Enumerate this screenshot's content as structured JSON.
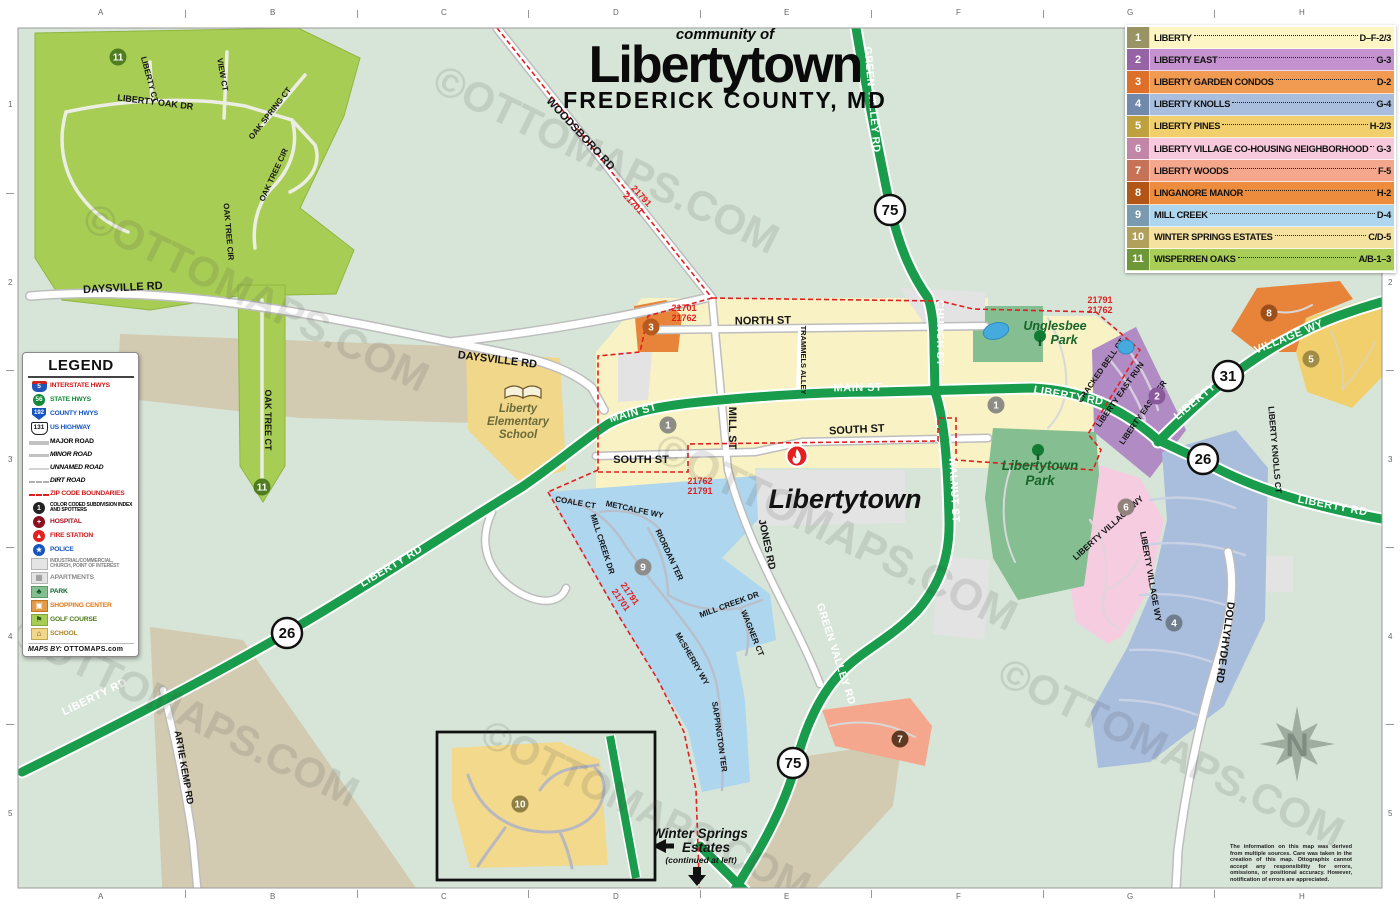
{
  "title": {
    "community": "community of",
    "name": "Libertytown",
    "county": "FREDERICK COUNTY, MD"
  },
  "watermark": "©OTTOMAPS.COM",
  "grid": {
    "cols": [
      "A",
      "B",
      "C",
      "D",
      "E",
      "F",
      "G",
      "H"
    ],
    "rows": [
      "1",
      "2",
      "3",
      "4",
      "5"
    ]
  },
  "index": {
    "rows": [
      {
        "num": "1",
        "name": "LIBERTY",
        "ref": "D–F-2/3",
        "row_color": "#fdf5c4",
        "num_color": "#9a9464"
      },
      {
        "num": "2",
        "name": "LIBERTY EAST",
        "ref": "G-3",
        "row_color": "#c493cf",
        "num_color": "#9663a5"
      },
      {
        "num": "3",
        "name": "LIBERTY GARDEN CONDOS",
        "ref": "D-2",
        "row_color": "#f09a52",
        "num_color": "#dd6f28"
      },
      {
        "num": "4",
        "name": "LIBERTY KNOLLS",
        "ref": "G-4",
        "row_color": "#a9bddd",
        "num_color": "#7189ab"
      },
      {
        "num": "5",
        "name": "LIBERTY PINES",
        "ref": "H-2/3",
        "row_color": "#f1cf6d",
        "num_color": "#bfa03e"
      },
      {
        "num": "6",
        "name": "LIBERTY VILLAGE CO-HOUSING NEIGHBORHOOD",
        "ref": "G-3",
        "row_color": "#f6c9dc",
        "num_color": "#c287a6"
      },
      {
        "num": "7",
        "name": "LIBERTY WOODS",
        "ref": "F-5",
        "row_color": "#f4a78d",
        "num_color": "#c67257"
      },
      {
        "num": "8",
        "name": "LINGANORE MANOR",
        "ref": "H-2",
        "row_color": "#ec8c3c",
        "num_color": "#b25618"
      },
      {
        "num": "9",
        "name": "MILL CREEK",
        "ref": "D-4",
        "row_color": "#aed6ee",
        "num_color": "#7a9ab0"
      },
      {
        "num": "10",
        "name": "WINTER SPRINGS ESTATES",
        "ref": "C/D-5",
        "row_color": "#f5e2a0",
        "num_color": "#b0a05c"
      },
      {
        "num": "11",
        "name": "WISPERREN OAKS",
        "ref": "A/B-1–3",
        "row_color": "#a9ce57",
        "num_color": "#6e9737"
      }
    ]
  },
  "legend": {
    "title": "LEGEND",
    "items": [
      {
        "label": "INTERSTATE HWYS",
        "num": "5",
        "color": "#d01818"
      },
      {
        "label": "STATE HWYS",
        "num": "56",
        "color": "#118a38"
      },
      {
        "label": "COUNTY HWYS",
        "num": "192",
        "color": "#1555c0"
      },
      {
        "label": "US HIGHWAY",
        "num": "131",
        "color": "#1555c0"
      },
      {
        "label": "MAJOR ROAD",
        "color": "#111111"
      },
      {
        "label": "MINOR ROAD",
        "color": "#111111"
      },
      {
        "label": "UNNAMED ROAD",
        "color": "#111111"
      },
      {
        "label": "DIRT ROAD",
        "color": "#111111"
      },
      {
        "label": "ZIP CODE BOUNDARIES",
        "color": "#d01818"
      },
      {
        "label": "COLOR CODED SUBDIVISION INDEX AND SPOTTERS",
        "color": "#111111"
      },
      {
        "label": "HOSPITAL",
        "color": "#b01020"
      },
      {
        "label": "FIRE STATION",
        "color": "#d01818"
      },
      {
        "label": "POLICE",
        "color": "#1555c0"
      },
      {
        "label": "INDUSTRIAL/COMMERCIAL, CHURCH, POINT OF INTEREST",
        "color": "#808080"
      },
      {
        "label": "APARTMENTS",
        "color": "#8a8a8a"
      },
      {
        "label": "PARK",
        "color": "#0f6a28"
      },
      {
        "label": "SHOPPING CENTER",
        "color": "#e07818"
      },
      {
        "label": "GOLF COURSE",
        "color": "#4a7a1a"
      },
      {
        "label": "SCHOOL",
        "color": "#a8862a"
      }
    ],
    "credit_prefix": "MAPS BY:",
    "credit_name": "OTTOMAPS.com"
  },
  "map": {
    "city": "Libertytown",
    "compass": "N",
    "streets": {
      "woodsboro": "WOODSBORO RD",
      "daysville": "DAYSVILLE RD",
      "north": "NORTH ST",
      "main": "MAIN ST",
      "south": "SOUTH ST",
      "mill": "MILL ST",
      "trammels": "TRAMMELS ALLEY",
      "church": "CHURCH ST",
      "walnut": "WALNUT ST",
      "jones": "JONES RD",
      "liberty_rd": "LIBERTY RD",
      "green_valley": "GREEN VALLEY RD",
      "artie_kemp": "ARTIE KEMP RD",
      "dollyhyde": "DOLLYHYDE RD",
      "liberty_word": "LIBERTY",
      "village_wy": "VILLAGE WY",
      "liberty_village_wy": "LIBERTY VILLAGE WY",
      "liberty_knolls_ct": "LIBERTY KNOLLS CT",
      "cracked_bell": "CRACKED BELL CT",
      "east_run": "LIBERTY EAST RUN",
      "east_ter": "LIBERTY EAST TER",
      "coale": "COALE CT",
      "metcalfe": "METCALFE WY",
      "mill_creek_dr": "MILL CREEK DR",
      "riordan": "RIORDAN TER",
      "wagner": "WAGNER CT",
      "mcsherry": "McSHERRY WY",
      "sappington": "SAPPINGTON TER",
      "oak_tree_ct": "OAK TREE CT",
      "oak_tree_cir": "OAK TREE CIR",
      "liberty_ct": "LIBERTY CT",
      "view_ct": "VIEW CT",
      "oak_spring_ct": "OAK SPRING CT",
      "liberty_oak_dr": "LIBERTY OAK DR",
      "croyden": "CROYDEN CT",
      "arlington": "ARLINGTON MILL RD",
      "fordham": "FORDHAM CT",
      "knighton": "KNIGHTON CT"
    },
    "places": {
      "unglesbee1": "Unglesbee",
      "unglesbee2": "Park",
      "park1": "Libertytown",
      "park2": "Park",
      "school1": "Liberty",
      "school2": "Elementary",
      "school3": "School"
    },
    "winter_springs": {
      "l1": "Winter Springs",
      "l2": "Estates",
      "l3": "(continued at left)"
    },
    "zips": {
      "z21701": "21701",
      "z21762": "21762",
      "z21791": "21791"
    },
    "shields": {
      "s75": "75",
      "s26": "26",
      "s31": "31"
    }
  },
  "note": "The information on this map was derived from multiple sources. Care was taken in the creation of this map. Ottographix cannot accept any responsibility for errors, omissions, or positional accuracy. However, notification of errors are appreciated."
}
